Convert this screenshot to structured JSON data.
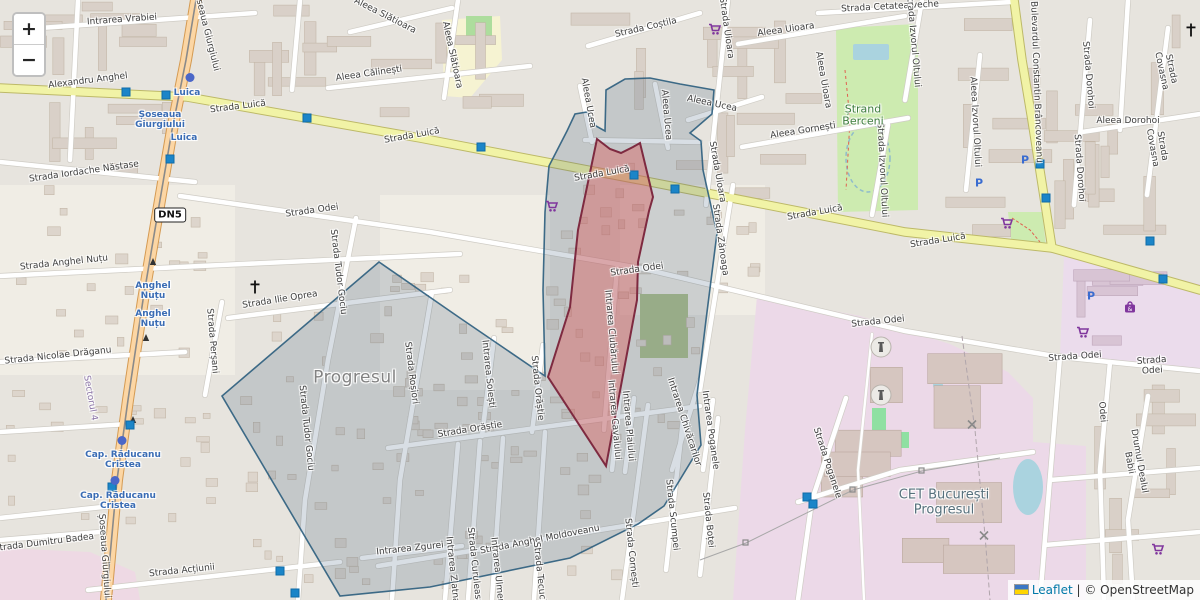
{
  "controls": {
    "zoom_in_label": "+",
    "zoom_out_label": "−"
  },
  "attribution": {
    "flag_icon": "ukraine-flag",
    "leaflet_link": "Leaflet",
    "separator": " | ",
    "osm_text": "© OpenStreetMap"
  },
  "route_shield": {
    "label": "DN5",
    "x": 170,
    "y": 215
  },
  "colors": {
    "highlight_area_fill": "#dc5a5a",
    "highlight_area_stroke": "#7e2a40",
    "survey_area_fill": "#3e5a78",
    "survey_area_stroke": "#2b5d7d",
    "primary_road": "#fcd6a4",
    "secondary_road": "#f1f3a6",
    "water": "#aad3df",
    "grass": "#cdebb0",
    "industrial_zone": "#ecd9e8",
    "transit_marker": "#1b85c8"
  },
  "place_labels": [
    {
      "text": "Progresul",
      "x": 355,
      "y": 378,
      "cls": "place"
    },
    {
      "text": "CET București\nProgresul",
      "x": 944,
      "y": 503,
      "cls": "industrial"
    },
    {
      "text": "Ștrand\nBerceni",
      "x": 863,
      "y": 116,
      "cls": "area-green"
    },
    {
      "text": "Sectorul 4",
      "x": 90,
      "y": 398,
      "r": 80,
      "cls": "admin"
    }
  ],
  "street_labels": [
    {
      "text": "Intrarea Vrabiei",
      "x": 122,
      "y": 20,
      "r": -4
    },
    {
      "text": "Alexandru Anghel",
      "x": 88,
      "y": 81,
      "r": -7
    },
    {
      "text": "Șoseaua Giurgiului",
      "x": 206,
      "y": 30,
      "r": 76
    },
    {
      "text": "Strada Luică",
      "x": 238,
      "y": 107,
      "r": -7
    },
    {
      "text": "Strada Luică",
      "x": 412,
      "y": 136,
      "r": -10
    },
    {
      "text": "Strada Luică",
      "x": 602,
      "y": 174,
      "r": -10
    },
    {
      "text": "Strada Luică",
      "x": 815,
      "y": 213,
      "r": -10
    },
    {
      "text": "Strada Luică",
      "x": 938,
      "y": 241,
      "r": -9
    },
    {
      "text": "Strada Coștila",
      "x": 646,
      "y": 28,
      "r": -13
    },
    {
      "text": "Aleea Slătioara",
      "x": 385,
      "y": 16,
      "r": 27
    },
    {
      "text": "Aleea Slătioara",
      "x": 452,
      "y": 55,
      "r": 78
    },
    {
      "text": "Aleea Călinești",
      "x": 369,
      "y": 74,
      "r": -8
    },
    {
      "text": "Aleea Uioara",
      "x": 786,
      "y": 30,
      "r": -8
    },
    {
      "text": "Aleea Uioara",
      "x": 823,
      "y": 80,
      "r": 80
    },
    {
      "text": "Strada Uioara",
      "x": 726,
      "y": 28,
      "r": 82
    },
    {
      "text": "Strada Uioara",
      "x": 717,
      "y": 172,
      "r": 80
    },
    {
      "text": "Strada Cetatea veche",
      "x": 890,
      "y": 7,
      "r": -3
    },
    {
      "text": "Aleea Gornești",
      "x": 803,
      "y": 131,
      "r": -9
    },
    {
      "text": "Aleea Ucea",
      "x": 588,
      "y": 103,
      "r": 80
    },
    {
      "text": "Aleea Ucea",
      "x": 666,
      "y": 115,
      "r": 85
    },
    {
      "text": "Aleea Ucea",
      "x": 712,
      "y": 104,
      "r": 12
    },
    {
      "text": "Aleea Dorohoi",
      "x": 1128,
      "y": 121
    },
    {
      "text": "Strada Dorohoi",
      "x": 1088,
      "y": 75,
      "r": 85
    },
    {
      "text": "Strada Dorohoi",
      "x": 1079,
      "y": 168,
      "r": 86
    },
    {
      "text": "Strada Covasna",
      "x": 1166,
      "y": 70,
      "r": 78
    },
    {
      "text": "Strada Covasna",
      "x": 1157,
      "y": 147,
      "r": 80
    },
    {
      "text": "Aleea Izvorul Oltului",
      "x": 975,
      "y": 122,
      "r": 87
    },
    {
      "text": "Strada Izvorul Oltului",
      "x": 913,
      "y": 40,
      "r": 85
    },
    {
      "text": "Strada Izvorul Oltului",
      "x": 882,
      "y": 170,
      "r": 87
    },
    {
      "text": "Bulevardul Constantin Brâncoveanu",
      "x": 1036,
      "y": 82,
      "r": 88
    },
    {
      "text": "Strada Iordache Năstase",
      "x": 84,
      "y": 172,
      "r": -8
    },
    {
      "text": "Strada Anghel Nuțu",
      "x": 64,
      "y": 263,
      "r": -6
    },
    {
      "text": "Strada Ilie Oprea",
      "x": 280,
      "y": 300,
      "r": -9
    },
    {
      "text": "Strada Nicolae Drăganu",
      "x": 58,
      "y": 356,
      "r": -6
    },
    {
      "text": "Strada Perșani",
      "x": 212,
      "y": 341,
      "r": 85
    },
    {
      "text": "Strada Odei",
      "x": 312,
      "y": 211,
      "r": -8
    },
    {
      "text": "Strada Odei",
      "x": 637,
      "y": 270,
      "r": -8
    },
    {
      "text": "Strada Odei",
      "x": 878,
      "y": 322,
      "r": -6
    },
    {
      "text": "Strada Odei",
      "x": 1075,
      "y": 357,
      "r": -4
    },
    {
      "text": "Strada Odei",
      "x": 1152,
      "y": 366,
      "r": -4
    },
    {
      "text": "Odei",
      "x": 1102,
      "y": 412,
      "r": 85
    },
    {
      "text": "Strada Zănoaga",
      "x": 720,
      "y": 240,
      "r": 82
    },
    {
      "text": "Strada Tudor Gociu",
      "x": 338,
      "y": 272,
      "r": 83
    },
    {
      "text": "Strada Tudor Gociu",
      "x": 306,
      "y": 428,
      "r": 84
    },
    {
      "text": "Strada Roșiori",
      "x": 411,
      "y": 373,
      "r": 83
    },
    {
      "text": "Intrarea Soiești",
      "x": 488,
      "y": 374,
      "r": 84
    },
    {
      "text": "Strada Orăștie",
      "x": 537,
      "y": 388,
      "r": 84
    },
    {
      "text": "Strada Orăștie",
      "x": 470,
      "y": 430,
      "r": -9
    },
    {
      "text": "Intrarea Zgurei",
      "x": 410,
      "y": 549,
      "r": -6
    },
    {
      "text": "Strada Anghel Moldoveanu",
      "x": 540,
      "y": 540,
      "r": -11
    },
    {
      "text": "Intrarea Zlatna",
      "x": 452,
      "y": 570,
      "r": 84
    },
    {
      "text": "Strada Curuleasa",
      "x": 474,
      "y": 566,
      "r": 84
    },
    {
      "text": "Intrarea Ulmeni",
      "x": 497,
      "y": 572,
      "r": 84
    },
    {
      "text": "Strada Tecuci",
      "x": 539,
      "y": 572,
      "r": 84
    },
    {
      "text": "Strada Cornești",
      "x": 631,
      "y": 553,
      "r": 84
    },
    {
      "text": "Strada Scumpei",
      "x": 672,
      "y": 515,
      "r": 84
    },
    {
      "text": "Strada Boței",
      "x": 708,
      "y": 520,
      "r": 84
    },
    {
      "text": "Intrarea Poganele",
      "x": 710,
      "y": 430,
      "r": 82
    },
    {
      "text": "Intrarea Cavalului",
      "x": 614,
      "y": 420,
      "r": 85
    },
    {
      "text": "Intrarea Plaiului",
      "x": 628,
      "y": 426,
      "r": 85
    },
    {
      "text": "Intrarea Ciubărului",
      "x": 611,
      "y": 332,
      "r": 85
    },
    {
      "text": "Intrarea Chivăcarilor",
      "x": 684,
      "y": 422,
      "r": 72
    },
    {
      "text": "Strada Poganele",
      "x": 827,
      "y": 463,
      "r": 72
    },
    {
      "text": "Strada Dumitru Badea",
      "x": 44,
      "y": 543,
      "r": -7
    },
    {
      "text": "Strada Acțiunii",
      "x": 182,
      "y": 571,
      "r": -6
    },
    {
      "text": "Șoseaua Giurgiului",
      "x": 104,
      "y": 556,
      "r": 86
    },
    {
      "text": "Drumul Dealul Babii",
      "x": 1134,
      "y": 462,
      "r": 80
    }
  ],
  "transit_labels": [
    {
      "text": "Luica",
      "x": 187,
      "y": 93
    },
    {
      "text": "Șoseaua\nGiurgiului",
      "x": 160,
      "y": 120
    },
    {
      "text": "Luica",
      "x": 184,
      "y": 138
    },
    {
      "text": "Anghel\nNuțu",
      "x": 153,
      "y": 291
    },
    {
      "text": "Anghel\nNuțu",
      "x": 153,
      "y": 319
    },
    {
      "text": "Cap. Răducanu\nCristea",
      "x": 123,
      "y": 460
    },
    {
      "text": "Cap. Răducanu\nCristea",
      "x": 118,
      "y": 501
    }
  ],
  "icons": [
    {
      "name": "supermarket-icon",
      "x": 715,
      "y": 30
    },
    {
      "name": "supermarket-icon",
      "x": 552,
      "y": 207
    },
    {
      "name": "supermarket-icon",
      "x": 1007,
      "y": 224
    },
    {
      "name": "supermarket-icon",
      "x": 1083,
      "y": 333
    },
    {
      "name": "supermarket-icon",
      "x": 1158,
      "y": 550
    },
    {
      "name": "mall-icon",
      "x": 1130,
      "y": 308
    },
    {
      "name": "parking-icon",
      "x": 1025,
      "y": 160
    },
    {
      "name": "parking-icon",
      "x": 979,
      "y": 183
    },
    {
      "name": "parking-icon",
      "x": 1091,
      "y": 296
    },
    {
      "name": "church-cross-icon",
      "x": 255,
      "y": 288
    },
    {
      "name": "church-cross-icon",
      "x": 1191,
      "y": 31
    },
    {
      "name": "monument-icon",
      "x": 881,
      "y": 349
    },
    {
      "name": "monument-icon",
      "x": 881,
      "y": 397
    },
    {
      "name": "pylon-icon",
      "x": 972,
      "y": 424
    },
    {
      "name": "pylon-icon",
      "x": 984,
      "y": 535
    },
    {
      "name": "bus-stop-marker",
      "x": 126,
      "y": 91
    },
    {
      "name": "bus-stop-marker",
      "x": 166,
      "y": 94
    },
    {
      "name": "bus-stop-marker",
      "x": 170,
      "y": 158
    },
    {
      "name": "bus-stop-marker",
      "x": 307,
      "y": 117
    },
    {
      "name": "bus-stop-marker",
      "x": 481,
      "y": 146
    },
    {
      "name": "bus-stop-marker",
      "x": 634,
      "y": 174
    },
    {
      "name": "bus-stop-marker",
      "x": 675,
      "y": 188
    },
    {
      "name": "bus-stop-marker",
      "x": 1040,
      "y": 163
    },
    {
      "name": "bus-stop-marker",
      "x": 1046,
      "y": 197
    },
    {
      "name": "bus-stop-marker",
      "x": 1150,
      "y": 240
    },
    {
      "name": "bus-stop-marker",
      "x": 1163,
      "y": 278
    },
    {
      "name": "bus-stop-marker",
      "x": 130,
      "y": 424
    },
    {
      "name": "bus-stop-marker",
      "x": 112,
      "y": 486
    },
    {
      "name": "bus-stop-marker",
      "x": 280,
      "y": 570
    },
    {
      "name": "bus-stop-marker",
      "x": 295,
      "y": 592
    },
    {
      "name": "bus-stop-marker",
      "x": 807,
      "y": 496
    },
    {
      "name": "bus-stop-marker",
      "x": 813,
      "y": 503
    },
    {
      "name": "transit-dot",
      "x": 190,
      "y": 77
    },
    {
      "name": "transit-dot",
      "x": 122,
      "y": 440
    },
    {
      "name": "transit-dot",
      "x": 115,
      "y": 480
    }
  ]
}
